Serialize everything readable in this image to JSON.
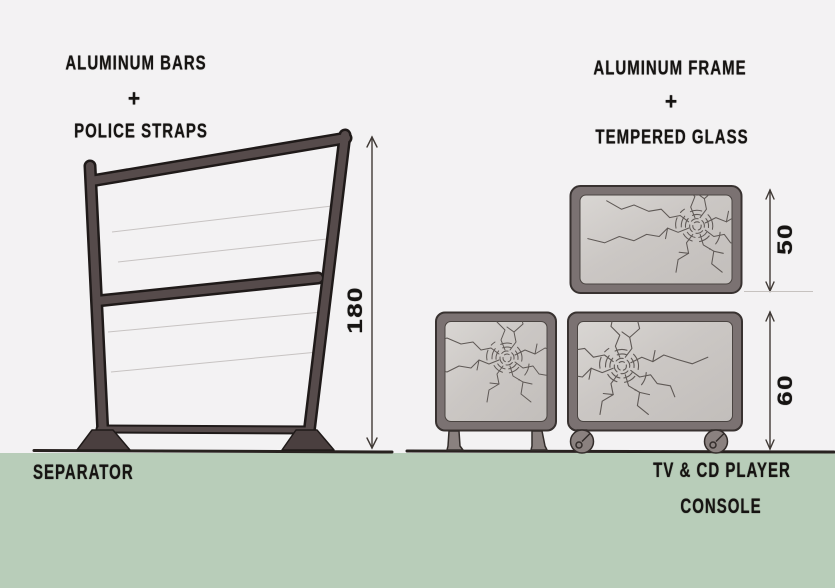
{
  "left_panel": {
    "material_line1": "ALUMINUM BARS",
    "plus": "+",
    "material_line2": "POLICE STRAPS",
    "product_label": "SEPARATOR",
    "dimension_height": "180"
  },
  "right_panel": {
    "material_line1": "ALUMINUM FRAME",
    "plus": "+",
    "material_line2": "TEMPERED GLASS",
    "product_label_line1": "TV & CD PLAYER",
    "product_label_line2": "CONSOLE",
    "dimension_top_unit": "50",
    "dimension_bottom_unit": "60"
  },
  "colors": {
    "paper": "#f3f2f3",
    "floor_band": "#b8cdb9",
    "separator_frame_fill": "#564b4b",
    "separator_frame_outline": "#1f1a19",
    "console_frame_fill": "#7b7272",
    "console_frame_outline": "#383230",
    "glass_fill": "#ccc8c5",
    "crack_line": "#5f5956",
    "ink": "#3a342f",
    "text": "#161412"
  }
}
